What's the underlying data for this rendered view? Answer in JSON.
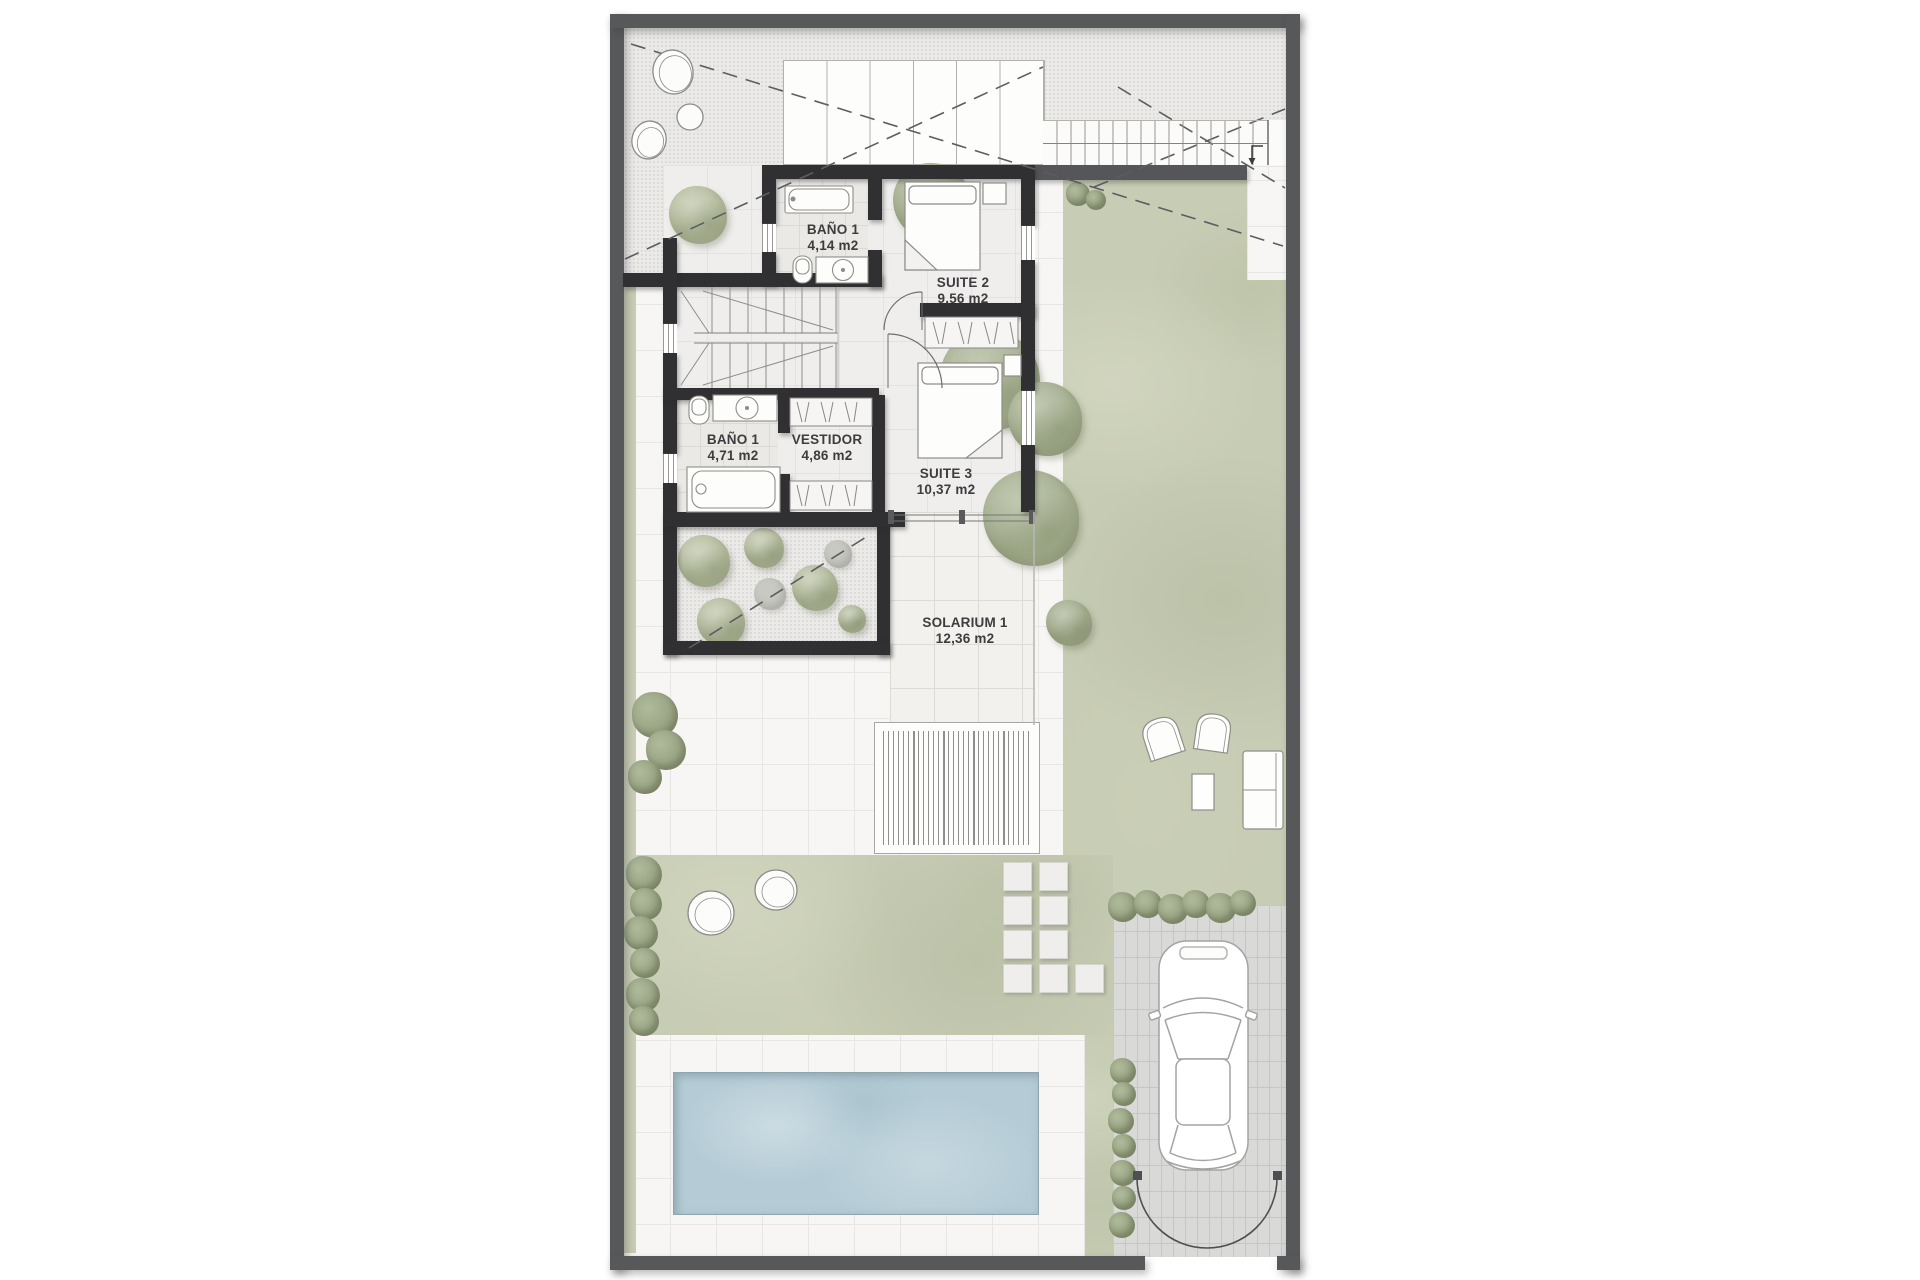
{
  "rooms": [
    {
      "name": "BAÑO 1",
      "area": "4,14 m2"
    },
    {
      "name": "SUITE 2",
      "area": "9,56 m2"
    },
    {
      "name": "BAÑO 1",
      "area": "4,71 m2"
    },
    {
      "name": "VESTIDOR",
      "area": "4,86 m2"
    },
    {
      "name": "SUITE 3",
      "area": "10,37 m2"
    },
    {
      "name": "SOLARIUM 1",
      "area": "12,36 m2"
    }
  ],
  "colors": {
    "frame": "#57585a",
    "wall": "#303032",
    "paving": "#f7f6f4",
    "terrace": "#ebeae8",
    "garden": "#c7ccb4",
    "tree": "#a9b394",
    "pool": "#b5ccd6",
    "driveway": "#d9d9d7",
    "label_text": "#3d3d3f"
  }
}
